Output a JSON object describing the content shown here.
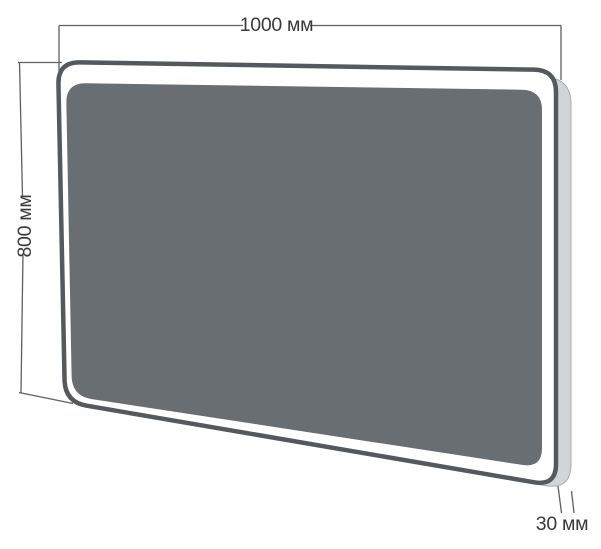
{
  "diagram": {
    "kind": "mirror-dimension-drawing",
    "labels": {
      "width": "1000 мм",
      "height": "800 мм",
      "depth": "30 мм"
    },
    "colors": {
      "background": "#ffffff",
      "glass": "#696e73",
      "frame": "#54595e",
      "led_band": "#ffffff",
      "side_edge": "#d2d5d7",
      "side_edge_border": "#a8acaf",
      "dimension_line": "#5f5f5f",
      "label_text": "#3a3a3a"
    }
  }
}
